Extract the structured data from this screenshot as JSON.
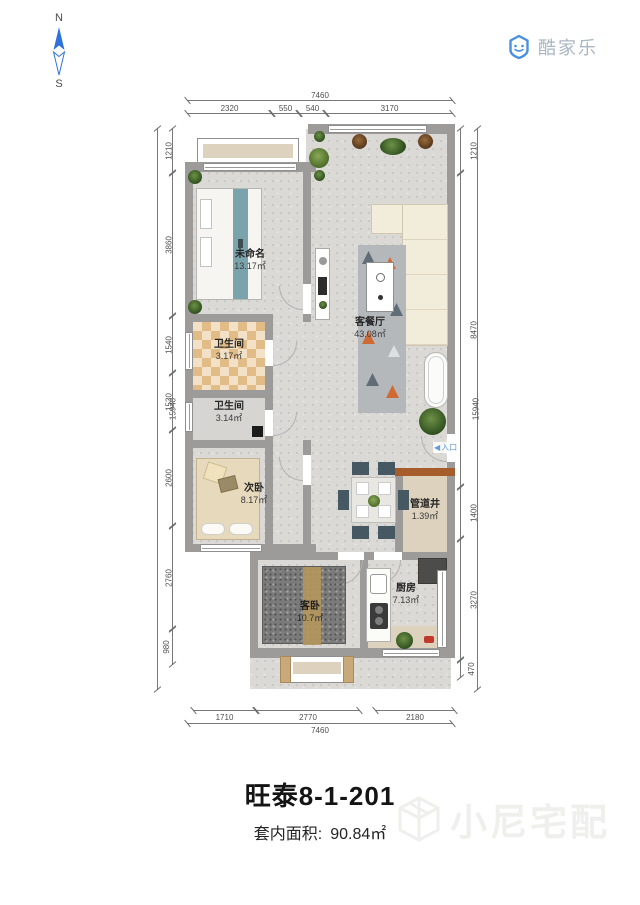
{
  "branding": {
    "logo": "酷家乐",
    "watermark": "小尼宅配"
  },
  "compass": {
    "north": "N",
    "south": "S"
  },
  "plan": {
    "entrance": {
      "arrow": "◀",
      "label": "入口"
    },
    "rooms": [
      {
        "name": "未命名",
        "area": "13.17㎡"
      },
      {
        "name": "客餐厅",
        "area": "43.08㎡"
      },
      {
        "name": "卫生间",
        "area": "3.17㎡"
      },
      {
        "name": "卫生间",
        "area": "3.14㎡"
      },
      {
        "name": "次卧",
        "area": "8.17㎡"
      },
      {
        "name": "管道井",
        "area": "1.39㎡"
      },
      {
        "name": "客卧",
        "area": "10.7㎡"
      },
      {
        "name": "厨房",
        "area": "7.13㎡"
      }
    ],
    "dims": {
      "top_total": "7460",
      "top_segments": [
        "2320",
        "550",
        "540",
        "3170"
      ],
      "left_total": "15940",
      "left_segments": [
        "1210",
        "3860",
        "1540",
        "1530",
        "2600",
        "2760",
        "980"
      ],
      "right_total": "15940",
      "right_segments": [
        "1210",
        "8470",
        "1400",
        "3270",
        "470"
      ],
      "bottom_total": "7460",
      "bottom_segments": [
        "1710",
        "2770",
        "2180"
      ]
    }
  },
  "footer": {
    "title": "旺泰8-1-201",
    "area_label": "套内面积:",
    "area_value": "90.84㎡"
  },
  "colors": {
    "accent": "#2f72d9",
    "wall": "#9c9b9a",
    "tile": "#e2bc86",
    "entry_blue": "#649bd8"
  }
}
